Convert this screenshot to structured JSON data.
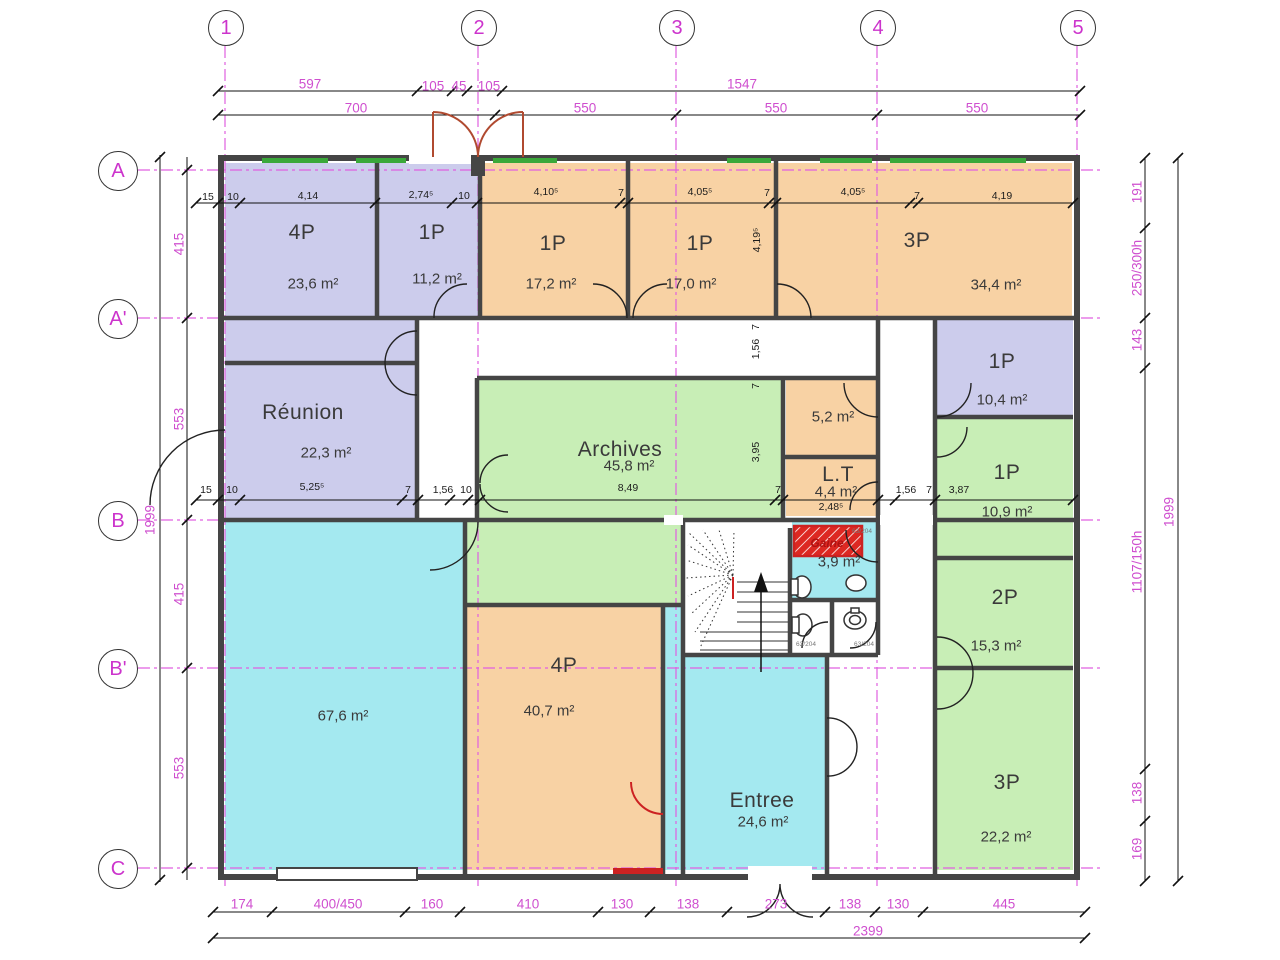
{
  "palette": {
    "magenta": "#cf4fcf",
    "dim_black": "#1c1c1c",
    "wall": "#454545",
    "red": "#cc2222",
    "door_red": "#b04a30",
    "window_green": "#3aa83a",
    "purple": "#ccccec",
    "orange": "#f8d2a4",
    "green": "#c8eeb6",
    "cyan": "#a4e9f0"
  },
  "grid": {
    "columns": [
      {
        "label": "1",
        "x": 225
      },
      {
        "label": "2",
        "x": 478
      },
      {
        "label": "3",
        "x": 676
      },
      {
        "label": "4",
        "x": 877
      },
      {
        "label": "5",
        "x": 1077
      }
    ],
    "rows": [
      {
        "label": "A",
        "y": 170
      },
      {
        "label": "A'",
        "y": 318
      },
      {
        "label": "B",
        "y": 520
      },
      {
        "label": "B'",
        "y": 668
      },
      {
        "label": "C",
        "y": 868
      }
    ]
  },
  "rooms": [
    {
      "id": "4p-a",
      "label": "4P",
      "area": "23,6 m²",
      "rect": [
        225,
        163,
        152,
        155
      ],
      "color": "purple",
      "lpos": [
        302,
        233
      ],
      "apos": [
        313,
        284
      ]
    },
    {
      "id": "1p-a",
      "label": "1P",
      "area": "11,2 m²",
      "rect": [
        379,
        163,
        99,
        155
      ],
      "color": "purple",
      "lpos": [
        432,
        233
      ],
      "apos": [
        437,
        279
      ]
    },
    {
      "id": "1p-b",
      "label": "1P",
      "area": "17,2 m²",
      "rect": [
        482,
        163,
        144,
        155
      ],
      "color": "orange",
      "lpos": [
        553,
        244
      ],
      "apos": [
        551,
        284
      ]
    },
    {
      "id": "1p-c",
      "label": "1P",
      "area": "17,0 m²",
      "rect": [
        630,
        163,
        144,
        155
      ],
      "color": "orange",
      "lpos": [
        700,
        244
      ],
      "apos": [
        691,
        284
      ]
    },
    {
      "id": "3p-a",
      "label": "3P",
      "area": "34,4 m²",
      "rect": [
        778,
        163,
        294,
        155
      ],
      "color": "orange",
      "lpos": [
        917,
        241
      ],
      "apos": [
        996,
        285
      ]
    },
    {
      "id": "hall-strip",
      "rect": [
        225,
        320,
        190,
        43
      ],
      "color": "purple"
    },
    {
      "id": "reunion",
      "label": "Réunion",
      "area": "22,3 m²",
      "rect": [
        225,
        365,
        190,
        153
      ],
      "color": "purple",
      "lpos": [
        303,
        413
      ],
      "apos": [
        326,
        453
      ]
    },
    {
      "id": "archives",
      "label": "Archives",
      "area": "45,8 m²",
      "rect": [
        479,
        380,
        302,
        138
      ],
      "color": "green",
      "lpos": [
        620,
        450
      ],
      "apos": [
        629,
        466
      ]
    },
    {
      "id": "archives-ext",
      "rect": [
        467,
        518,
        214,
        87
      ],
      "color": "green"
    },
    {
      "id": "room-5-2",
      "area": "5,2 m²",
      "rect": [
        786,
        380,
        90,
        75
      ],
      "color": "orange",
      "apos": [
        833,
        417
      ]
    },
    {
      "id": "room-lt",
      "label": "L.T",
      "area": "4,4 m²",
      "rect": [
        786,
        459,
        90,
        57
      ],
      "color": "orange",
      "lpos": [
        838,
        475
      ],
      "apos": [
        836,
        492
      ]
    },
    {
      "id": "1p-d",
      "label": "1P",
      "area": "10,4 m²",
      "rect": [
        937,
        320,
        136,
        95
      ],
      "color": "purple",
      "lpos": [
        1002,
        362
      ],
      "apos": [
        1002,
        400
      ]
    },
    {
      "id": "1p-e",
      "label": "1P",
      "area": "10,9 m²",
      "rect": [
        937,
        419,
        136,
        137
      ],
      "color": "green",
      "lpos": [
        1007,
        473
      ],
      "apos": [
        1007,
        512
      ]
    },
    {
      "id": "2p",
      "label": "2P",
      "area": "15,3 m²",
      "rect": [
        937,
        560,
        136,
        106
      ],
      "color": "green",
      "lpos": [
        1005,
        598
      ],
      "apos": [
        996,
        646
      ]
    },
    {
      "id": "3p-b",
      "label": "3P",
      "area": "22,2 m²",
      "rect": [
        937,
        670,
        136,
        200
      ],
      "color": "green",
      "lpos": [
        1007,
        783
      ],
      "apos": [
        1006,
        837
      ]
    },
    {
      "id": "grande-salle",
      "area": "67,6 m²",
      "rect": [
        225,
        522,
        238,
        348
      ],
      "color": "cyan",
      "apos": [
        343,
        716
      ]
    },
    {
      "id": "4p-b",
      "label": "4P",
      "area": "40,7 m²",
      "rect": [
        467,
        607,
        194,
        263
      ],
      "color": "orange",
      "lpos": [
        564,
        666
      ],
      "apos": [
        549,
        711
      ]
    },
    {
      "id": "entree-corridor",
      "rect": [
        664,
        607,
        19,
        263
      ],
      "color": "cyan"
    },
    {
      "id": "entree",
      "label": "Entree",
      "area": "24,6 m²",
      "rect": [
        685,
        657,
        140,
        213
      ],
      "color": "cyan",
      "lpos": [
        762,
        801
      ],
      "apos": [
        763,
        822
      ]
    },
    {
      "id": "wc",
      "area": "3,9 m²",
      "rect": [
        792,
        522,
        86,
        76
      ],
      "color": "cyan",
      "apos": [
        839,
        562
      ]
    }
  ],
  "dim_labels": [
    {
      "t": "597",
      "x": 310,
      "y": 84,
      "c": "m"
    },
    {
      "t": "105",
      "x": 433,
      "y": 86,
      "c": "m"
    },
    {
      "t": "45",
      "x": 459,
      "y": 86,
      "c": "m"
    },
    {
      "t": "105",
      "x": 489,
      "y": 86,
      "c": "m"
    },
    {
      "t": "1547",
      "x": 742,
      "y": 84,
      "c": "m"
    },
    {
      "t": "700",
      "x": 356,
      "y": 108,
      "c": "m"
    },
    {
      "t": "550",
      "x": 585,
      "y": 108,
      "c": "m"
    },
    {
      "t": "550",
      "x": 776,
      "y": 108,
      "c": "m"
    },
    {
      "t": "550",
      "x": 977,
      "y": 108,
      "c": "m"
    },
    {
      "t": "174",
      "x": 242,
      "y": 904,
      "c": "m"
    },
    {
      "t": "400/450",
      "x": 338,
      "y": 904,
      "c": "m"
    },
    {
      "t": "160",
      "x": 432,
      "y": 904,
      "c": "m"
    },
    {
      "t": "410",
      "x": 528,
      "y": 904,
      "c": "m"
    },
    {
      "t": "130",
      "x": 622,
      "y": 904,
      "c": "m"
    },
    {
      "t": "138",
      "x": 688,
      "y": 904,
      "c": "m"
    },
    {
      "t": "273",
      "x": 776,
      "y": 904,
      "c": "m"
    },
    {
      "t": "138",
      "x": 850,
      "y": 904,
      "c": "m"
    },
    {
      "t": "130",
      "x": 898,
      "y": 904,
      "c": "m"
    },
    {
      "t": "445",
      "x": 1004,
      "y": 904,
      "c": "m"
    },
    {
      "t": "2399",
      "x": 868,
      "y": 931,
      "c": "m"
    },
    {
      "t": "415",
      "x": 179,
      "y": 244,
      "c": "m",
      "r": 1
    },
    {
      "t": "553",
      "x": 179,
      "y": 419,
      "c": "m",
      "r": 1
    },
    {
      "t": "415",
      "x": 179,
      "y": 594,
      "c": "m",
      "r": 1
    },
    {
      "t": "553",
      "x": 179,
      "y": 768,
      "c": "m",
      "r": 1
    },
    {
      "t": "1999",
      "x": 150,
      "y": 520,
      "c": "m",
      "r": 1
    },
    {
      "t": "191",
      "x": 1137,
      "y": 192,
      "c": "m",
      "r": 1
    },
    {
      "t": "250/300h",
      "x": 1137,
      "y": 268,
      "c": "m",
      "r": 1
    },
    {
      "t": "143",
      "x": 1137,
      "y": 340,
      "c": "m",
      "r": 1
    },
    {
      "t": "1107/150h",
      "x": 1137,
      "y": 562,
      "c": "m",
      "r": 1
    },
    {
      "t": "138",
      "x": 1137,
      "y": 793,
      "c": "m",
      "r": 1
    },
    {
      "t": "169",
      "x": 1137,
      "y": 849,
      "c": "m",
      "r": 1
    },
    {
      "t": "1999",
      "x": 1169,
      "y": 512,
      "c": "m",
      "r": 1
    },
    {
      "t": "15",
      "x": 208,
      "y": 197,
      "c": "k"
    },
    {
      "t": "10",
      "x": 233,
      "y": 197,
      "c": "k"
    },
    {
      "t": "4,14",
      "x": 308,
      "y": 196,
      "c": "k"
    },
    {
      "t": "2,74⁵",
      "x": 421,
      "y": 195,
      "c": "k"
    },
    {
      "t": "10",
      "x": 464,
      "y": 196,
      "c": "k"
    },
    {
      "t": "4,10⁵",
      "x": 546,
      "y": 192,
      "c": "k"
    },
    {
      "t": "7",
      "x": 621,
      "y": 193,
      "c": "k"
    },
    {
      "t": "4,05⁵",
      "x": 700,
      "y": 192,
      "c": "k"
    },
    {
      "t": "7",
      "x": 767,
      "y": 193,
      "c": "k"
    },
    {
      "t": "4,05⁵",
      "x": 853,
      "y": 192,
      "c": "k"
    },
    {
      "t": "7",
      "x": 917,
      "y": 196,
      "c": "k"
    },
    {
      "t": "4,19",
      "x": 1002,
      "y": 196,
      "c": "k"
    },
    {
      "t": "4,19⁵",
      "x": 757,
      "y": 240,
      "c": "k",
      "r": 1
    },
    {
      "t": "1,56",
      "x": 756,
      "y": 349,
      "c": "k",
      "r": 1
    },
    {
      "t": "7",
      "x": 756,
      "y": 327,
      "c": "k",
      "r": 1
    },
    {
      "t": "7",
      "x": 756,
      "y": 386,
      "c": "k",
      "r": 1
    },
    {
      "t": "3,95",
      "x": 756,
      "y": 452,
      "c": "k",
      "r": 1
    },
    {
      "t": "15",
      "x": 206,
      "y": 490,
      "c": "k"
    },
    {
      "t": "10",
      "x": 232,
      "y": 490,
      "c": "k"
    },
    {
      "t": "5,25⁵",
      "x": 312,
      "y": 487,
      "c": "k"
    },
    {
      "t": "7",
      "x": 408,
      "y": 490,
      "c": "k"
    },
    {
      "t": "1,56",
      "x": 443,
      "y": 490,
      "c": "k"
    },
    {
      "t": "10",
      "x": 466,
      "y": 490,
      "c": "k"
    },
    {
      "t": "8,49",
      "x": 628,
      "y": 488,
      "c": "k"
    },
    {
      "t": "7",
      "x": 778,
      "y": 490,
      "c": "k"
    },
    {
      "t": "1,56",
      "x": 906,
      "y": 490,
      "c": "k"
    },
    {
      "t": "7",
      "x": 929,
      "y": 490,
      "c": "k"
    },
    {
      "t": "3,87",
      "x": 959,
      "y": 490,
      "c": "k"
    },
    {
      "t": "2,48⁵",
      "x": 831,
      "y": 507,
      "c": "k"
    },
    {
      "t": "63/204",
      "x": 862,
      "y": 532,
      "c": "g"
    },
    {
      "t": "63/204",
      "x": 806,
      "y": 645,
      "c": "g"
    },
    {
      "t": "63/204",
      "x": 864,
      "y": 645,
      "c": "g"
    },
    {
      "t": "Gaine",
      "x": 827,
      "y": 543,
      "c": "r"
    }
  ]
}
